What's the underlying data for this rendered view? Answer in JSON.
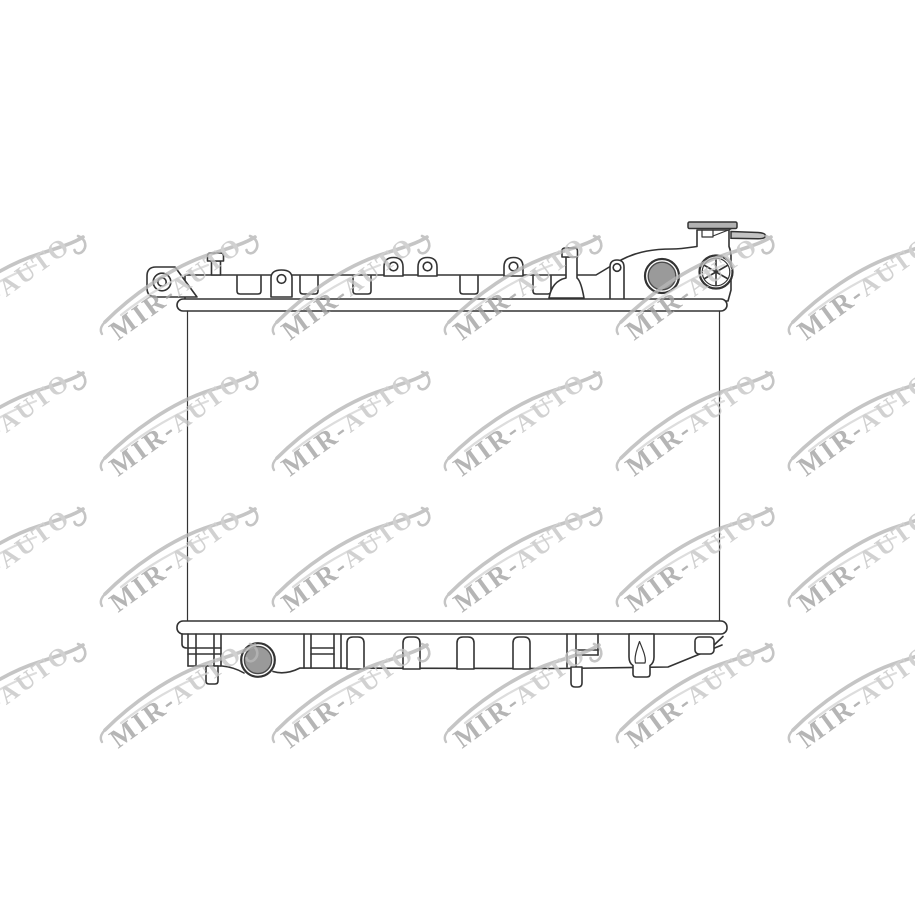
{
  "image": {
    "description": "Technical line drawing of an automotive radiator (top tank with filler cap and inlet port, core, bottom tank with outlet port and drain), shown as a watermarked product photo on white background",
    "background": "#ffffff"
  },
  "colors": {
    "line": "#333333",
    "port_fill": "#9a9a9a",
    "port_rim": "#4a4a4a",
    "cap_fill": "#b2b2b2",
    "tube_fill": "#c3c3c3"
  },
  "watermark": {
    "prefix": "MIR-",
    "suffix": "AUTO",
    "angle_deg": -36,
    "opacity": 0.8,
    "prefix_color": "#a3a3a3",
    "suffix_color": "#c6c6c6",
    "swoosh_color": "#b7b7b7",
    "swoosh_light_color": "#d5d5d5",
    "grid": {
      "x_start": -54,
      "x_step": 172,
      "cols": 6,
      "y_start": 341,
      "y_step": 136,
      "rows": 4
    }
  }
}
